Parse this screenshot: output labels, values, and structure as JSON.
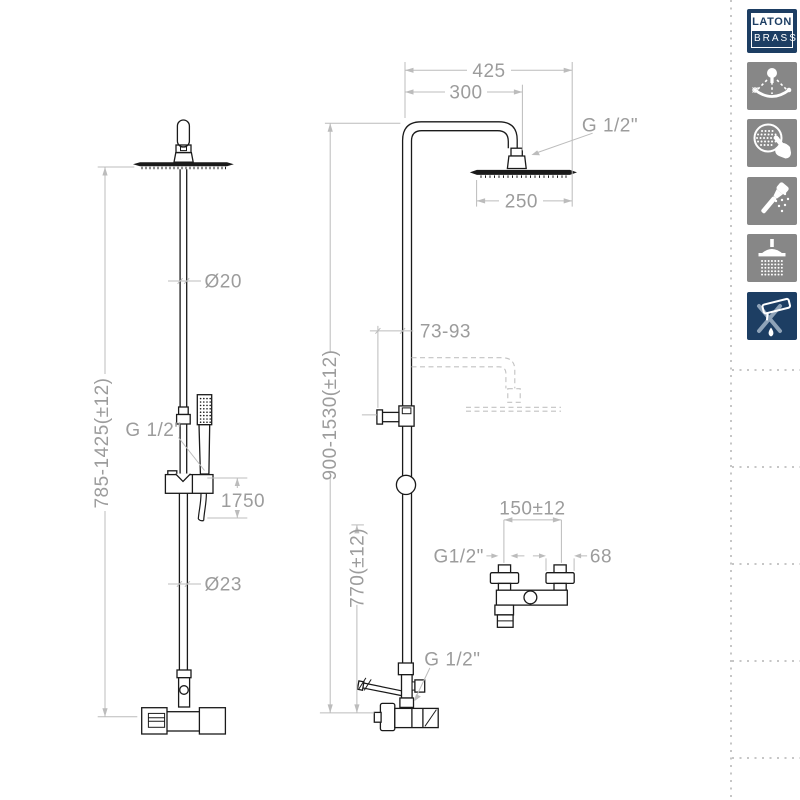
{
  "brand": {
    "top": "LATON",
    "bottom": "BRASS"
  },
  "colors": {
    "navy": "#1d3e63",
    "icon_gray": "#878787",
    "line": "#1a1a1a",
    "dim_line": "#b8b8b8",
    "dim_text": "#9c9c9c"
  },
  "drawing": {
    "front_view": {
      "pipe_diameter_top": "Ø20",
      "height_range": "785-1425(±12)",
      "hand_shower_connection": "G 1/2\"",
      "hose_length": "1750",
      "pipe_diameter_bottom": "Ø23"
    },
    "side_view": {
      "arm_reach_total": "425",
      "arm_reach_to_center": "300",
      "head_connection": "G 1/2\"",
      "head_diameter": "250",
      "wall_distance": "73-93",
      "total_height_range": "900-1530(±12)",
      "outlet_height": "770(±12)",
      "outlet_connection": "G 1/2\""
    },
    "mixer_view": {
      "inlet_spacing": "150±12",
      "inlet_connection": "G1/2\"",
      "escutcheon_diameter": "68"
    }
  },
  "sidebar": {
    "icons": [
      {
        "name": "adjustable-shower-head"
      },
      {
        "name": "easy-clean-nozzles"
      },
      {
        "name": "hand-shower"
      },
      {
        "name": "rain-shower-head"
      },
      {
        "name": "anti-limescale"
      }
    ]
  }
}
